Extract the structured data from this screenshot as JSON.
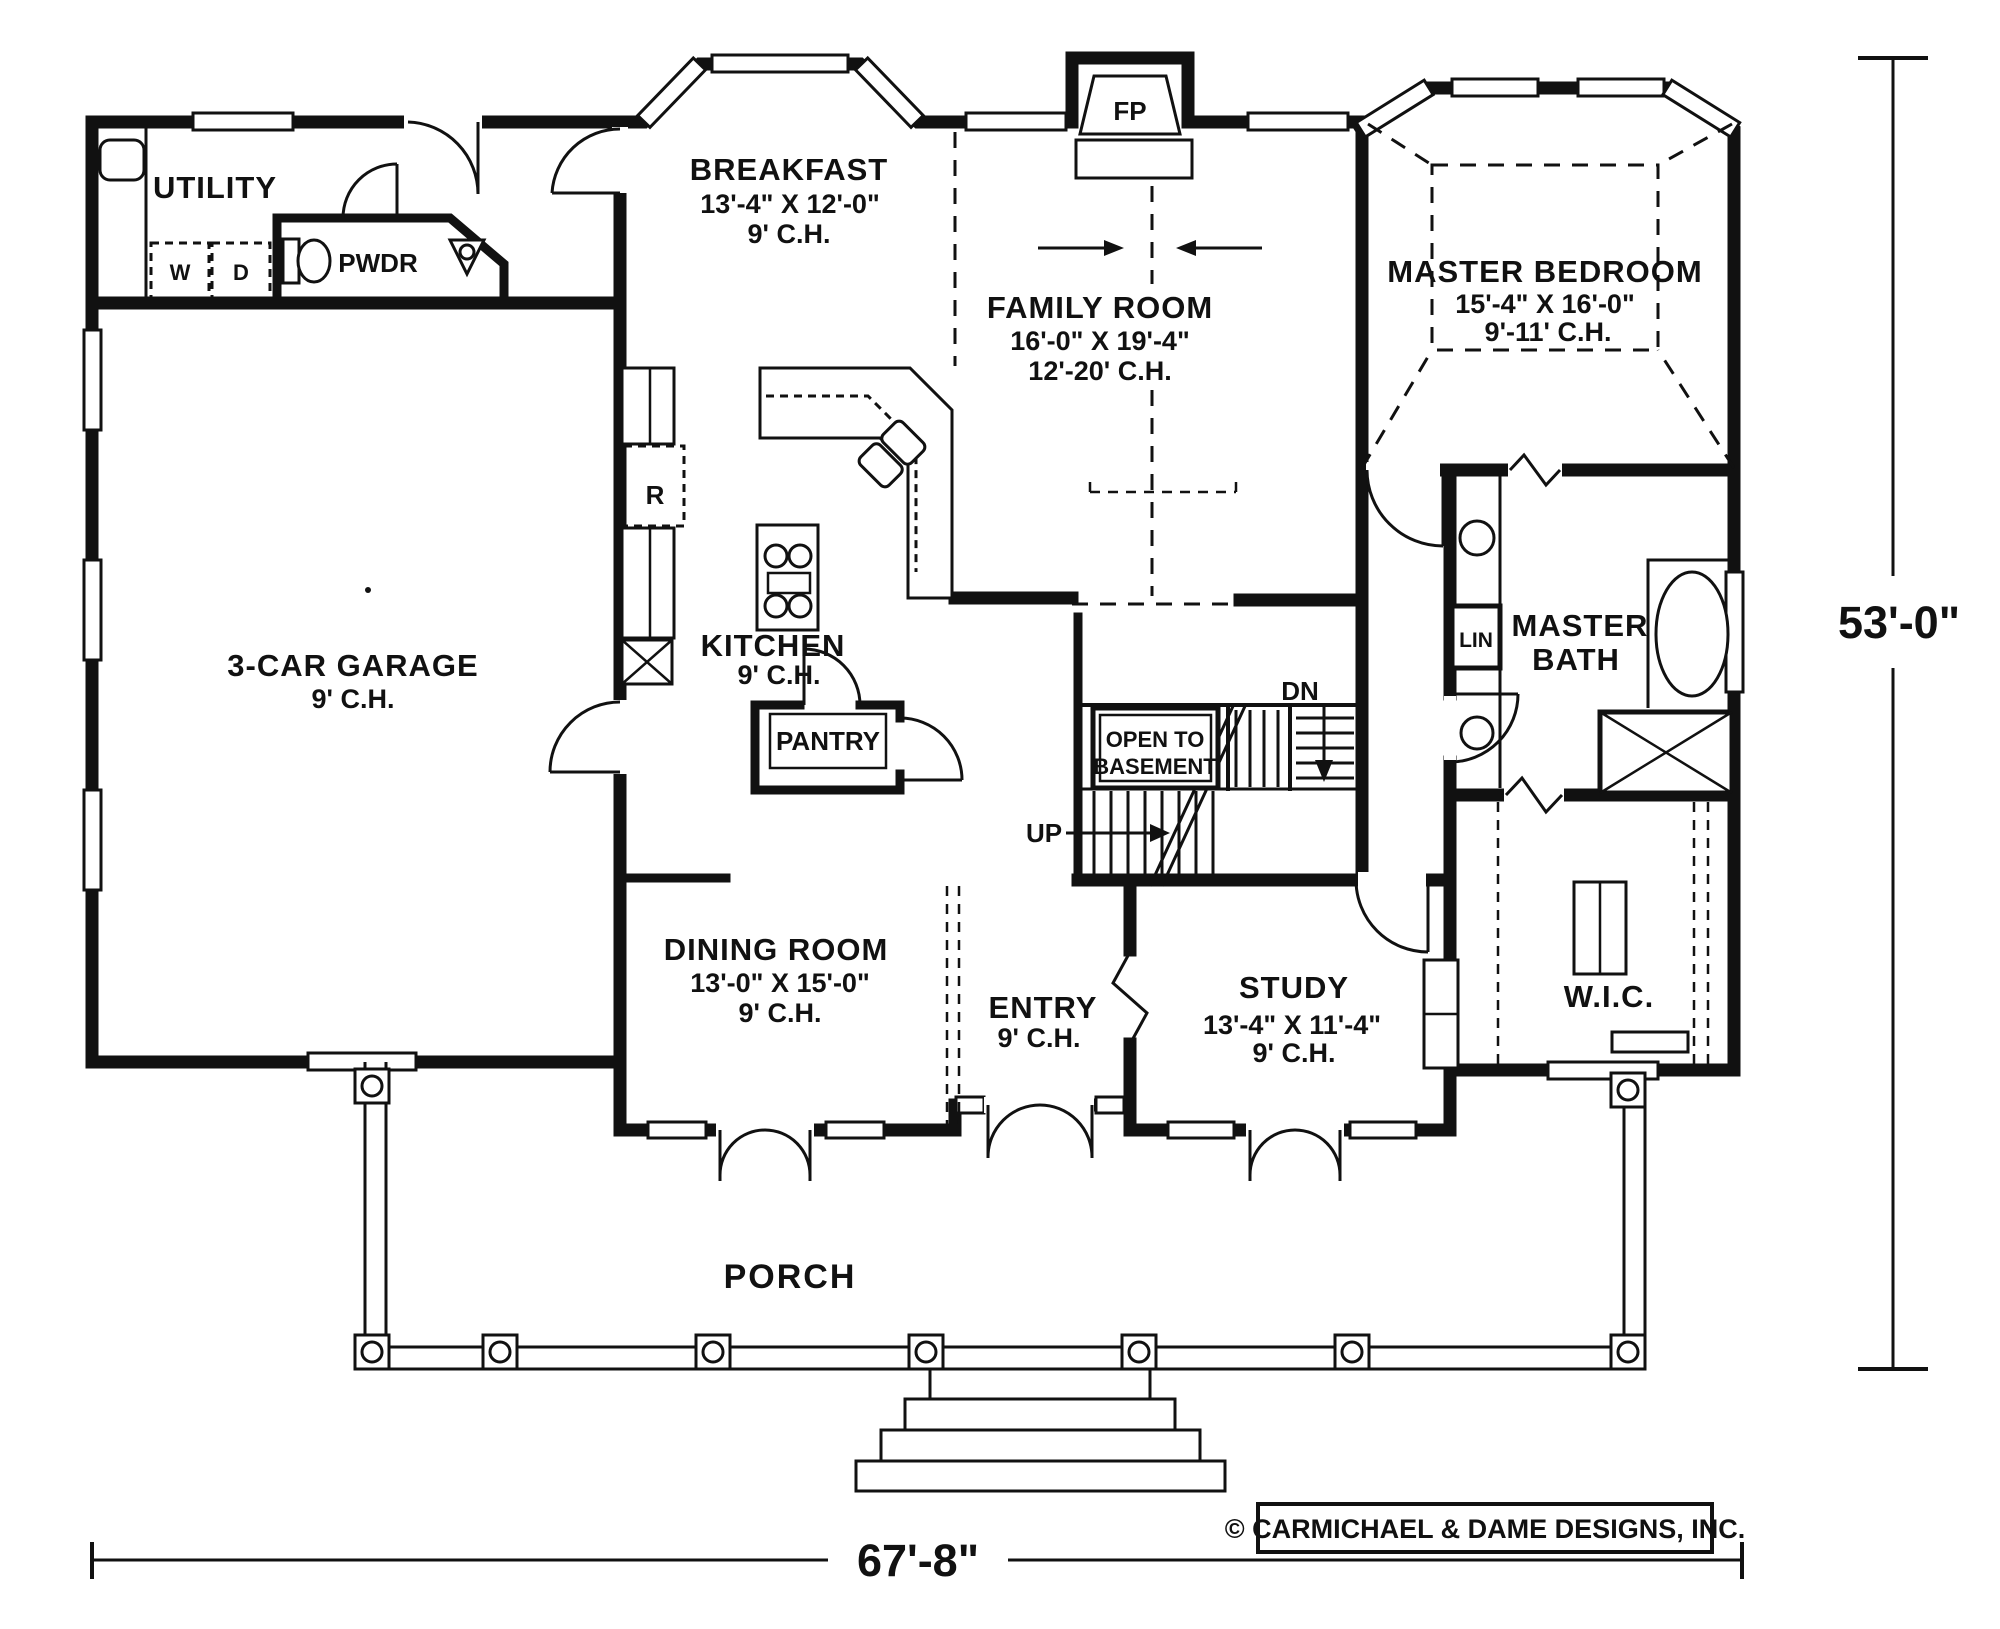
{
  "rooms": {
    "utility": {
      "label": "UTILITY"
    },
    "washer": {
      "label": "W"
    },
    "dryer": {
      "label": "D"
    },
    "powder": {
      "label": "PWDR"
    },
    "breakfast": {
      "label": "BREAKFAST",
      "size": "13'-4\" X 12'-0\"",
      "ceiling": "9' C.H."
    },
    "family_room": {
      "label": "FAMILY ROOM",
      "size": "16'-0\" X 19'-4\"",
      "ceiling": "12'-20' C.H."
    },
    "master_bedroom": {
      "label": "MASTER BEDROOM",
      "size": "15'-4\" X 16'-0\"",
      "ceiling": "9'-11' C.H."
    },
    "garage": {
      "label": "3-CAR GARAGE",
      "ceiling": "9' C.H."
    },
    "kitchen": {
      "label": "KITCHEN",
      "ceiling": "9' C.H."
    },
    "refrigerator": {
      "label": "R"
    },
    "pantry": {
      "label": "PANTRY"
    },
    "fireplace": {
      "label": "FP"
    },
    "linen": {
      "label": "LIN"
    },
    "master_bath": {
      "label_line1": "MASTER",
      "label_line2": "BATH"
    },
    "dining_room": {
      "label": "DINING ROOM",
      "size": "13'-0\" X 15'-0\"",
      "ceiling": "9' C.H."
    },
    "entry": {
      "label": "ENTRY",
      "ceiling": "9' C.H."
    },
    "study": {
      "label": "STUDY",
      "size": "13'-4\" X 11'-4\"",
      "ceiling": "9' C.H."
    },
    "wic": {
      "label": "W.I.C."
    },
    "porch": {
      "label": "PORCH"
    }
  },
  "stairs": {
    "open_to_line1": "OPEN TO",
    "open_to_line2": "BASEMENT",
    "up": "UP",
    "down": "DN"
  },
  "dimensions": {
    "overall_width": "67'-8\"",
    "overall_depth": "53'-0\""
  },
  "copyright": "© CARMICHAEL & DAME DESIGNS, INC.",
  "colors": {
    "ink": "#111111",
    "paper": "#ffffff"
  }
}
